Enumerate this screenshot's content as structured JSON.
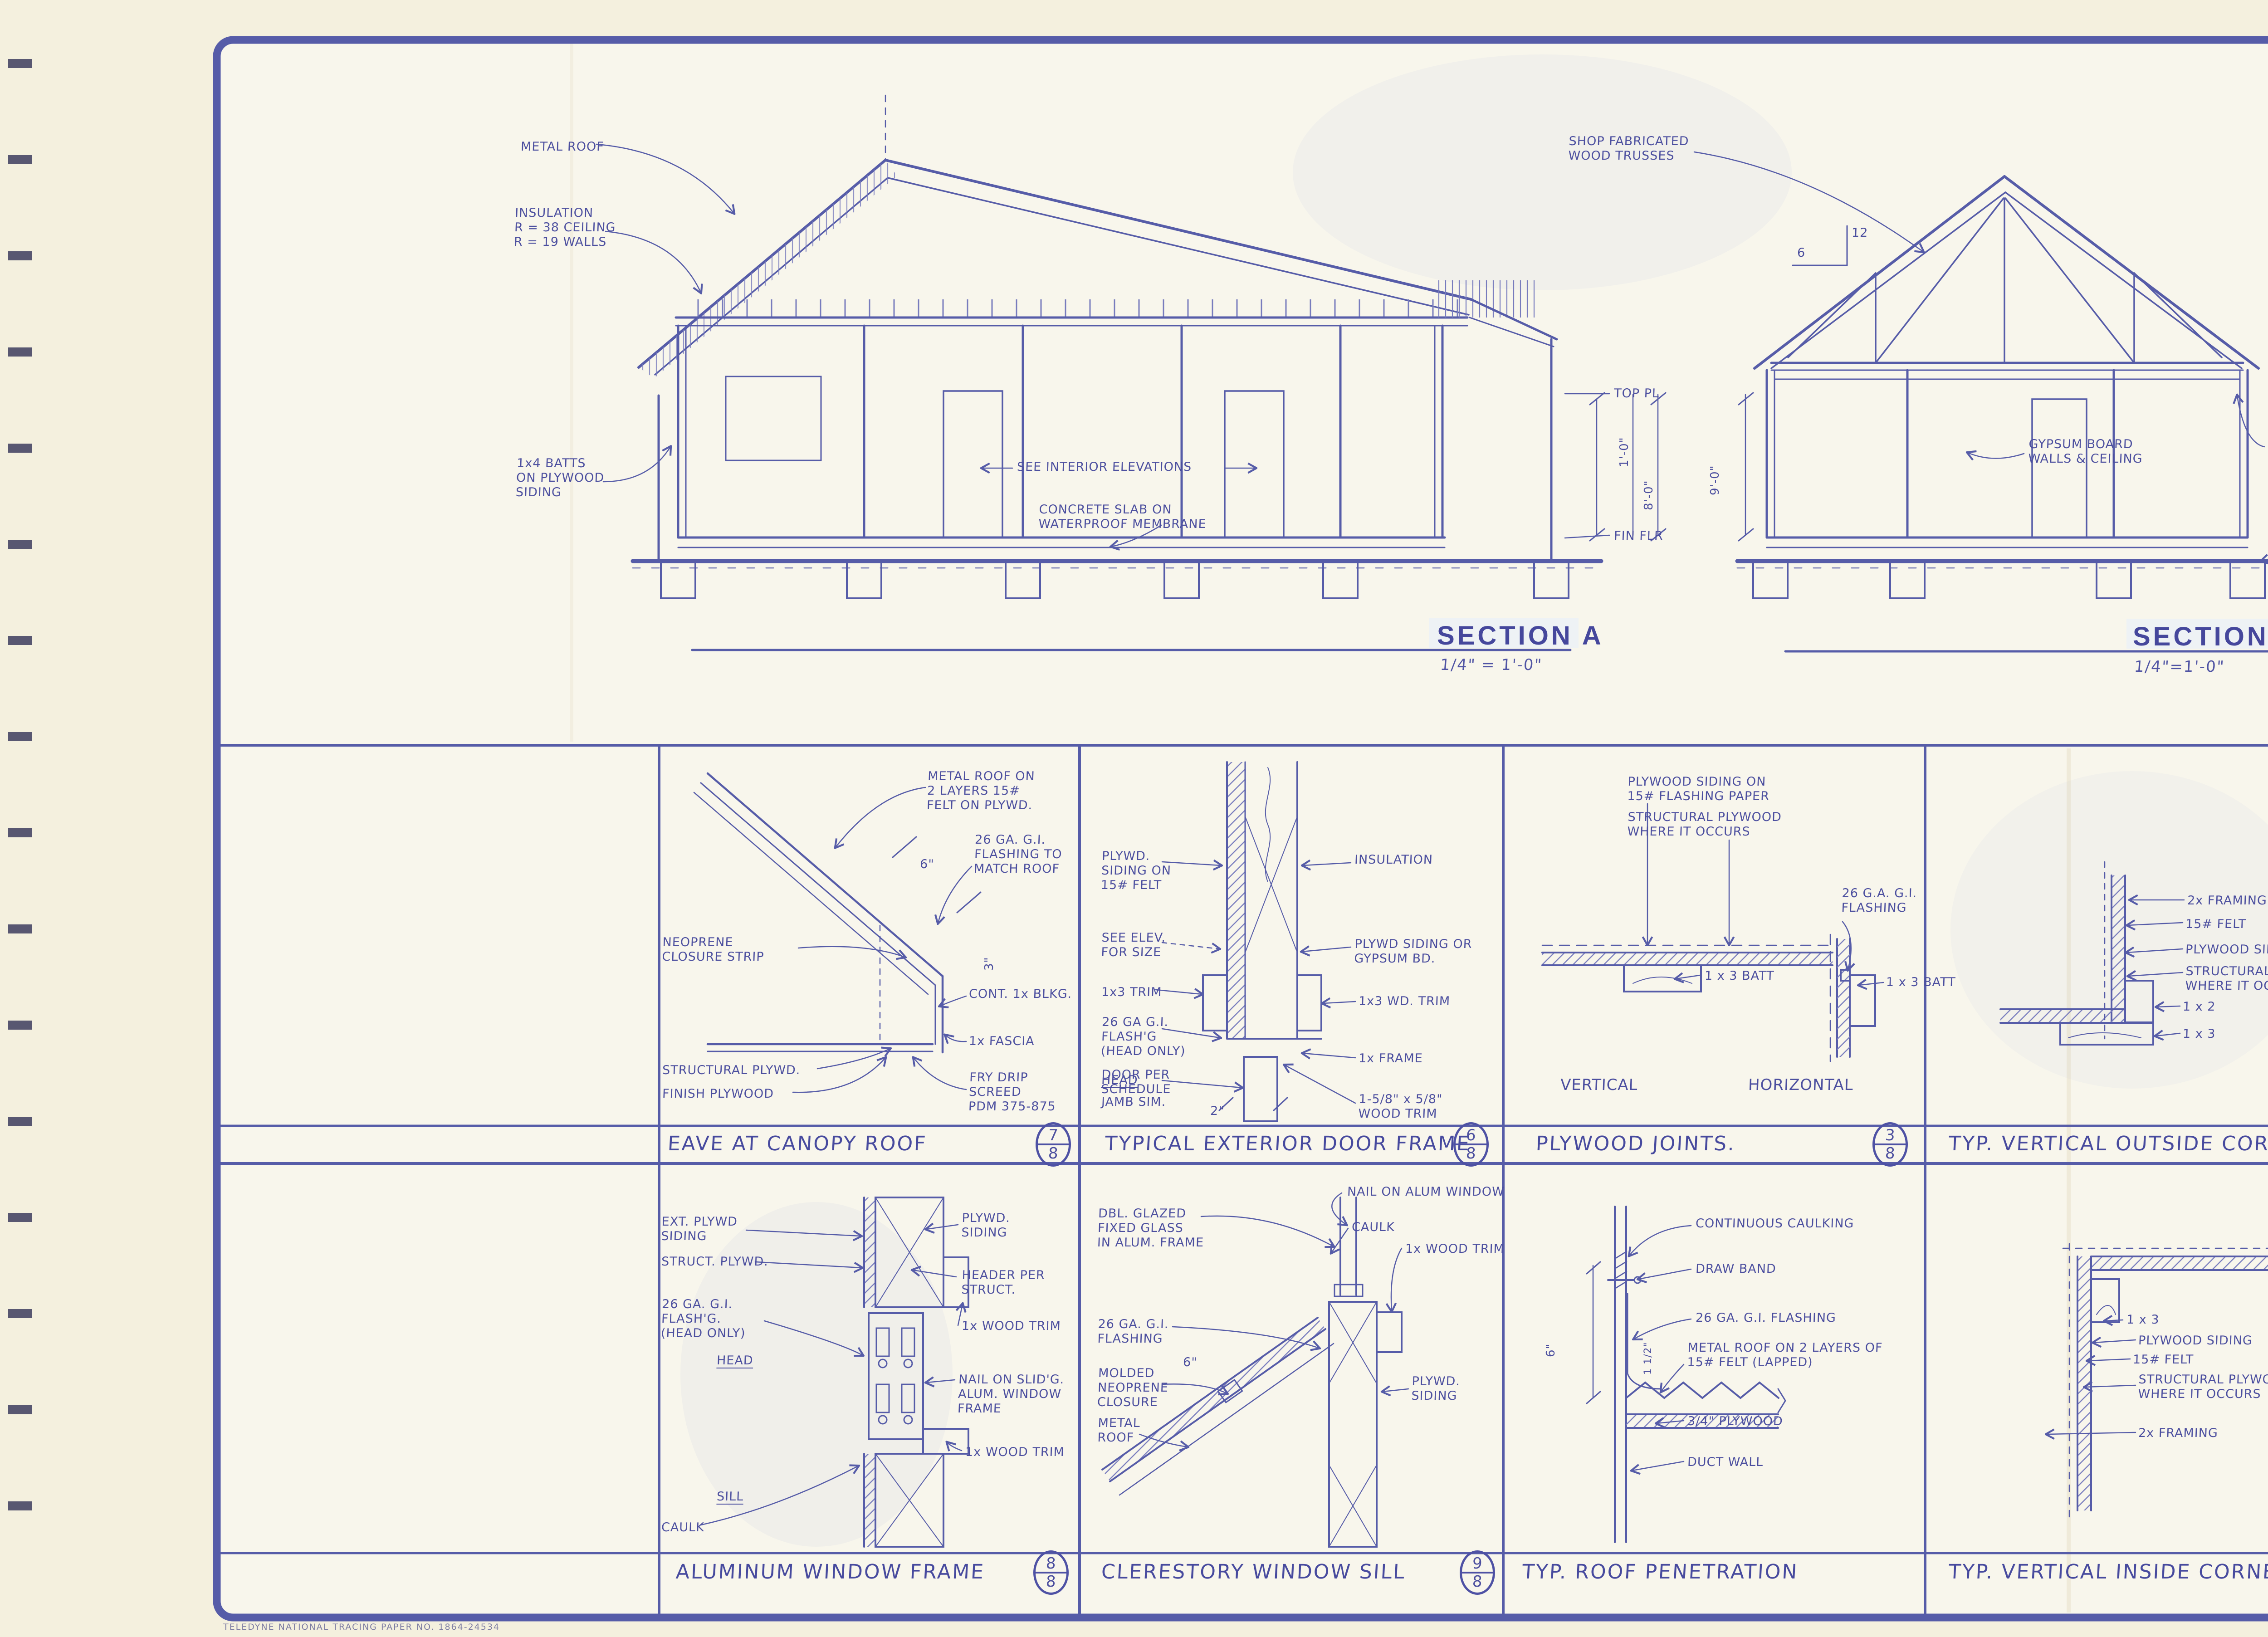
{
  "sheet": {
    "ink_color": "#4e4fa2",
    "paper_color": "#f4f0de",
    "firm_block_color": "#4a4687",
    "paper_brand": "TELEDYNE NATIONAL TRACING PAPER    NO. 1864-24534"
  },
  "sections": [
    {
      "name": "SECTION A",
      "scale": "1/4\" = 1'-0\"",
      "annotations": [
        "METAL ROOF",
        "INSULATION\nR = 38 CEILING\nR = 19 WALLS",
        "1x4 BATTS\nON PLYWOOD\nSIDING",
        "SEE INTERIOR ELEVATIONS",
        "CONCRETE SLAB ON\nWATERPROOF MEMBRANE",
        "TOP PL",
        "FIN FLR",
        "1'-0\"",
        "8'-0\""
      ]
    },
    {
      "name": "SECTION B",
      "scale": "1/4\"=1'-0\"",
      "annotations": [
        "SHOP FABRICATED\nWOOD TRUSSES",
        "12",
        "6",
        "9'-0\"",
        "GYPSUM BOARD\nWALLS & CEILING",
        "PLYWD\nSOFFIT",
        "FIN GRADE"
      ]
    }
  ],
  "details": [
    {
      "title": "EAVE AT CANOPY ROOF",
      "ref_top": "7",
      "ref_bottom": "8",
      "annotations": [
        "METAL ROOF ON\n2 LAYERS 15#\nFELT ON PLYWD.",
        "26 GA. G.I.\nFLASHING TO\nMATCH ROOF",
        "6\"",
        "NEOPRENE\nCLOSURE STRIP",
        "CONT. 1x BLKG.",
        "1x FASCIA",
        "STRUCTURAL PLYWD.",
        "FINISH PLYWOOD",
        "FRY DRIP\nSCREED\nPDM 375-875",
        "3\""
      ]
    },
    {
      "title": "TYPICAL EXTERIOR DOOR FRAME",
      "ref_top": "6",
      "ref_bottom": "8",
      "annotations": [
        "PLYWD.\nSIDING ON\n15# FELT",
        "INSULATION",
        "SEE ELEV.\nFOR SIZE",
        "PLYWD SIDING OR\nGYPSUM BD.",
        "1x3 TRIM",
        "1x3 WD. TRIM",
        "26 GA G.I.\nFLASH'G\n(HEAD ONLY)",
        "1x FRAME",
        "DOOR PER\nSCHEDULE",
        "1-5/8\" x 5/8\"\nWOOD TRIM",
        "HEAD",
        "JAMB SIM.",
        "2\""
      ]
    },
    {
      "title": "PLYWOOD JOINTS.",
      "ref_top": "3",
      "ref_bottom": "8",
      "annotations": [
        "PLYWOOD SIDING ON\n15# FLASHING PAPER",
        "STRUCTURAL PLYWOOD\nWHERE IT OCCURS",
        "26 G.A. G.I.\nFLASHING",
        "1 x 3 BATT",
        "1 x 3 BATT",
        "VERTICAL",
        "HORIZONTAL"
      ]
    },
    {
      "title": "TYP. VERTICAL OUTSIDE CORNER",
      "ref_top": "1",
      "ref_bottom": "8",
      "annotations": [
        "2x FRAMING",
        "15# FELT",
        "PLYWOOD SIDING",
        "STRUCTURAL PLYWOOD\nWHERE IT OCCURS.",
        "1 x 2",
        "1 x 3"
      ]
    },
    {
      "title": "ALUMINUM WINDOW FRAME",
      "ref_top": "8",
      "ref_bottom": "8",
      "annotations": [
        "EXT. PLYWD\nSIDING",
        "PLYWD.\nSIDING",
        "STRUCT. PLYWD.",
        "HEADER PER\nSTRUCT.",
        "26 GA. G.I.\nFLASH'G.\n(HEAD ONLY)",
        "1x WOOD TRIM",
        "HEAD",
        "NAIL ON SLID'G.\nALUM. WINDOW\nFRAME",
        "1x WOOD TRIM",
        "SILL",
        "CAULK"
      ]
    },
    {
      "title": "CLERESTORY WINDOW SILL",
      "ref_top": "9",
      "ref_bottom": "8",
      "annotations": [
        "NAIL ON ALUM WINDOW",
        "DBL. GLAZED\nFIXED GLASS\nIN ALUM. FRAME",
        "CAULK",
        "1x WOOD TRIM",
        "26 GA. G.I.\nFLASHING",
        "MOLDED\nNEOPRENE\nCLOSURE",
        "6\"",
        "METAL\nROOF",
        "PLYWD.\nSIDING"
      ]
    },
    {
      "title": "TYP. ROOF PENETRATION",
      "annotations": [
        "CONTINUOUS CAULKING",
        "DRAW BAND",
        "26 GA. G.I. FLASHING",
        "METAL ROOF ON 2 LAYERS OF\n15# FELT (LAPPED)",
        "3/4\" PLYWOOD",
        "DUCT WALL",
        "6\"",
        "1 1/2\""
      ]
    },
    {
      "title": "TYP. VERTICAL INSIDE CORNER.",
      "ref_top": "2",
      "ref_bottom": "8",
      "annotations": [
        "1 x 3",
        "PLYWOOD SIDING",
        "15# FELT",
        "STRUCTURAL PLYWOOD\nWHERE IT OCCURS",
        "2x FRAMING"
      ]
    }
  ],
  "title_block": {
    "revisions": {
      "header": "REVISIONS",
      "by_label": "BY",
      "row_count": 8
    },
    "project": {
      "line1": "CRANE FLAT CAMPUS",
      "line2": "YOSEMITE INSTITUTE"
    },
    "sheet_title": {
      "line1": "BATH HOUSE SECTIONS",
      "line2": "SCHOOL HOUSE &",
      "line3": "BATH HOUSE DETAILS"
    },
    "firm": {
      "name1": "Flood",
      "name2": "Meyer",
      "name3": "Sutton &",
      "name4": "Associates",
      "disc1": "Architecture",
      "disc2": "Planning",
      "disc3": "Economics",
      "addr1": "1408 Santa Monica Mall",
      "addr2": "Third Floor",
      "addr3": "Santa Monica, California 90401",
      "addr4": "213 451-1384"
    },
    "job": {
      "number_1": "104-70073",
      "number_2": "10450",
      "date_label": "DATE",
      "date": "4-15-1983",
      "scale_label": "SCALE",
      "scale": "1/4\"=1'-0\"",
      "sheet_number": "8",
      "of_label": "OF",
      "total_sheets": "9",
      "sheets_label": "SHEETS"
    }
  }
}
